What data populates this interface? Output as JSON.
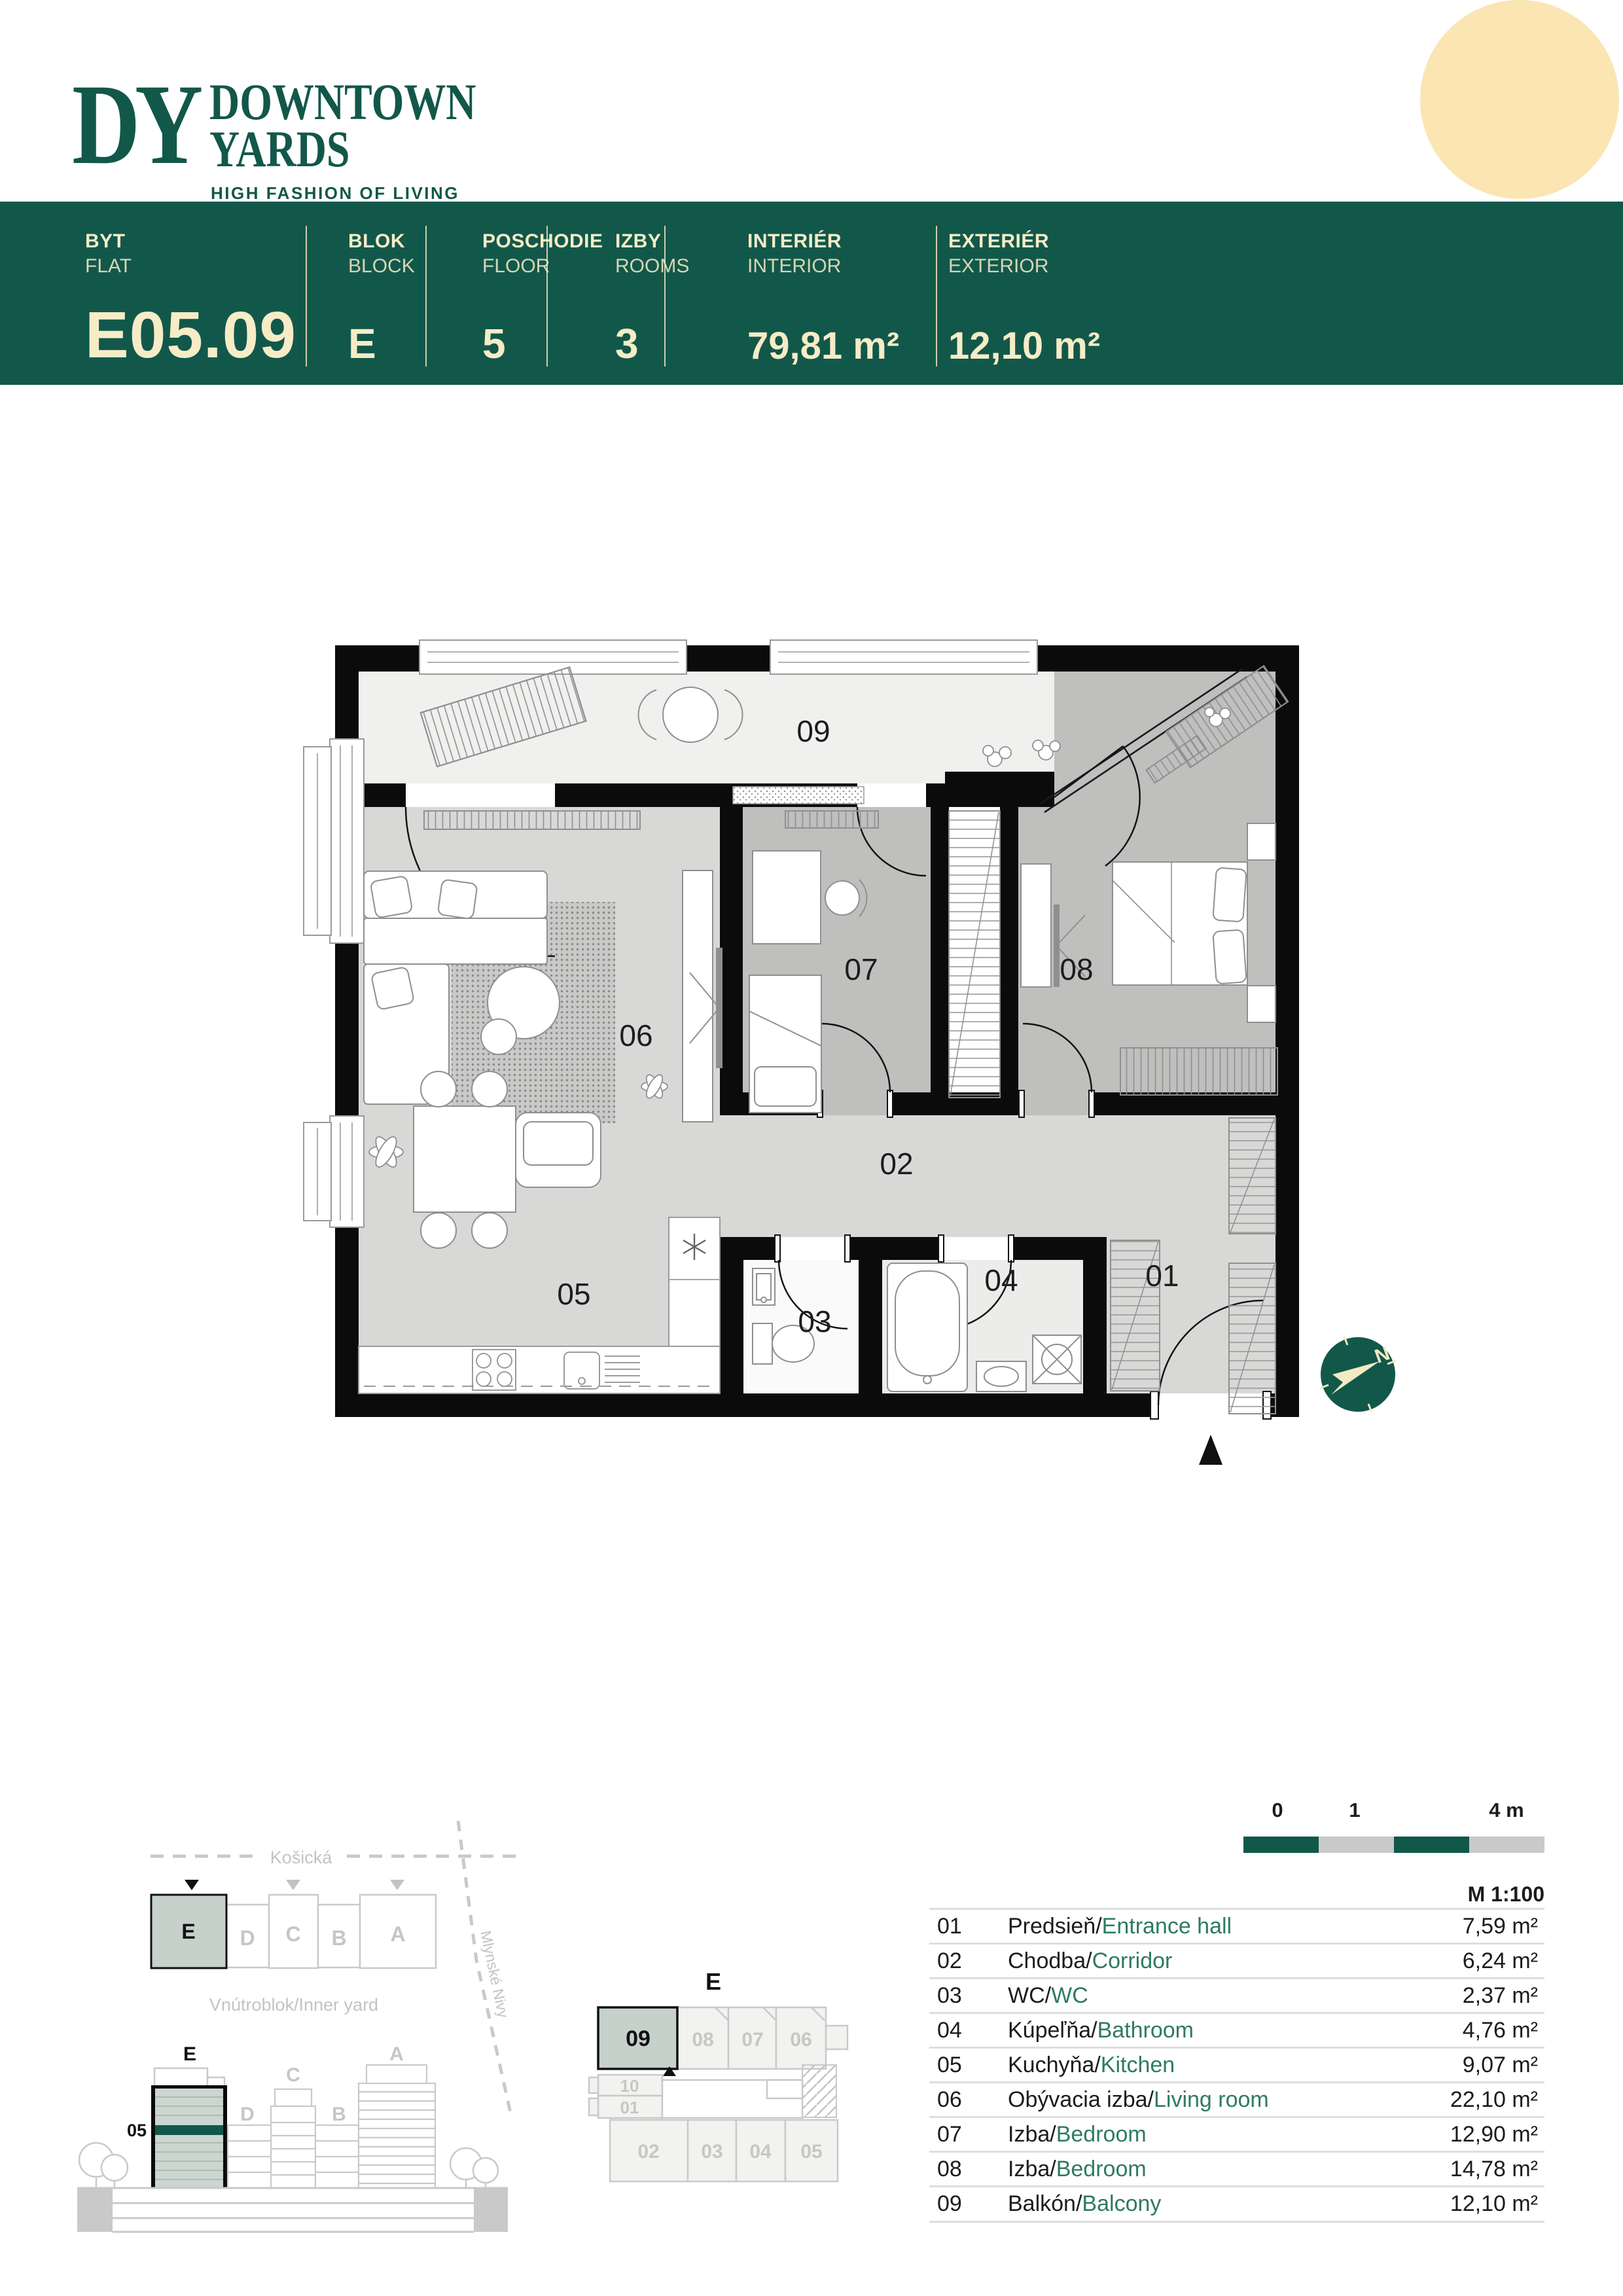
{
  "brand": {
    "monogram": "DY",
    "name_line1": "DOWNTOWN",
    "name_line2": "YARDS",
    "tagline": "HIGH FASHION OF LIVING"
  },
  "header": {
    "cols": [
      {
        "sk": "BYT",
        "en": "FLAT",
        "value": "E05.09"
      },
      {
        "sk": "BLOK",
        "en": "BLOCK",
        "value": "E"
      },
      {
        "sk": "POSCHODIE",
        "en": "FLOOR",
        "value": "5"
      },
      {
        "sk": "IZBY",
        "en": "ROOMS",
        "value": "3"
      },
      {
        "sk": "INTERIÉR",
        "en": "INTERIOR",
        "value": "79,81 m²"
      },
      {
        "sk": "EXTERIÉR",
        "en": "EXTERIOR",
        "value": "12,10 m²"
      }
    ]
  },
  "plan": {
    "rooms": {
      "r01": "01",
      "r02": "02",
      "r03": "03",
      "r04": "04",
      "r05": "05",
      "r06": "06",
      "r07": "07",
      "r08": "08",
      "r09": "09"
    },
    "compass": "N"
  },
  "site": {
    "street_top": "Košická",
    "street_right": "Mlynské Nivy",
    "inner_yard": "Vnútroblok/Inner yard",
    "blocks": {
      "e": "E",
      "d": "D",
      "c": "C",
      "b": "B",
      "a": "A"
    }
  },
  "elevation": {
    "block_e": "E",
    "floor": "05",
    "d": "D",
    "c": "C",
    "b": "B",
    "a": "A"
  },
  "keyplan": {
    "block": "E",
    "u09": "09",
    "u08": "08",
    "u07": "07",
    "u06": "06",
    "u10": "10",
    "u01": "01",
    "u02": "02",
    "u03": "03",
    "u04": "04",
    "u05": "05"
  },
  "scalebar": {
    "t0": "0",
    "t1": "1",
    "t2": "4 m",
    "ratio": "M 1:100"
  },
  "legend": {
    "sep": "/",
    "rows": [
      {
        "num": "01",
        "sk": "Predsieň",
        "en": "Entrance hall",
        "area": "7,59 m²"
      },
      {
        "num": "02",
        "sk": "Chodba",
        "en": "Corridor",
        "area": "6,24 m²"
      },
      {
        "num": "03",
        "sk": "WC",
        "en": "WC",
        "area": "2,37 m²"
      },
      {
        "num": "04",
        "sk": "Kúpeľňa",
        "en": "Bathroom",
        "area": "4,76 m²"
      },
      {
        "num": "05",
        "sk": "Kuchyňa",
        "en": "Kitchen",
        "area": "9,07 m²"
      },
      {
        "num": "06",
        "sk": "Obývacia izba",
        "en": "Living room",
        "area": "22,10 m²"
      },
      {
        "num": "07",
        "sk": "Izba",
        "en": "Bedroom",
        "area": "12,90 m²"
      },
      {
        "num": "08",
        "sk": "Izba",
        "en": "Bedroom",
        "area": "14,78 m²"
      },
      {
        "num": "09",
        "sk": "Balkón",
        "en": "Balcony",
        "area": "12,10 m²"
      }
    ]
  }
}
